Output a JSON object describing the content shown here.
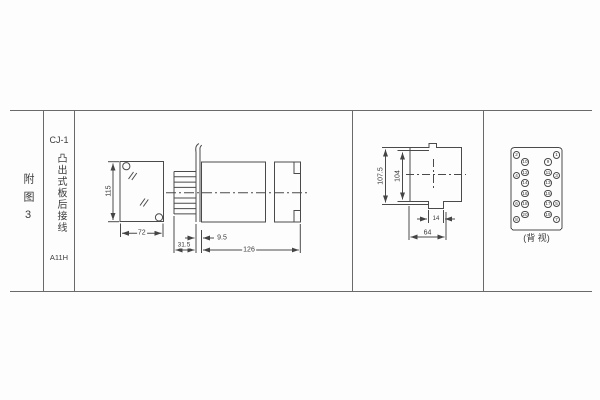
{
  "index_column": {
    "label": "附图3"
  },
  "title_column": {
    "model": "CJ-1",
    "mount_type": "凸出式板后接线",
    "code": "A11H"
  },
  "figures": {
    "front_view": {
      "dim_height": "115",
      "dim_width": "72"
    },
    "side_view": {
      "dim_pin": "31.5",
      "dim_offset": "9.5",
      "dim_length": "126"
    },
    "profile_view": {
      "dim_overall": "107.5",
      "dim_case": "104",
      "dim_tab": "14",
      "dim_width": "64"
    },
    "terminal_view": {
      "caption": "(背 视)",
      "terminals": {
        "outer_left": [
          "2",
          "4",
          "6",
          "8"
        ],
        "inner_left": [
          "10",
          "12",
          "14",
          "16",
          "18",
          "20"
        ],
        "inner_right": [
          "9",
          "11",
          "13",
          "15",
          "17",
          "19"
        ],
        "outer_right": [
          "1",
          "3",
          "5",
          "7"
        ]
      }
    }
  }
}
